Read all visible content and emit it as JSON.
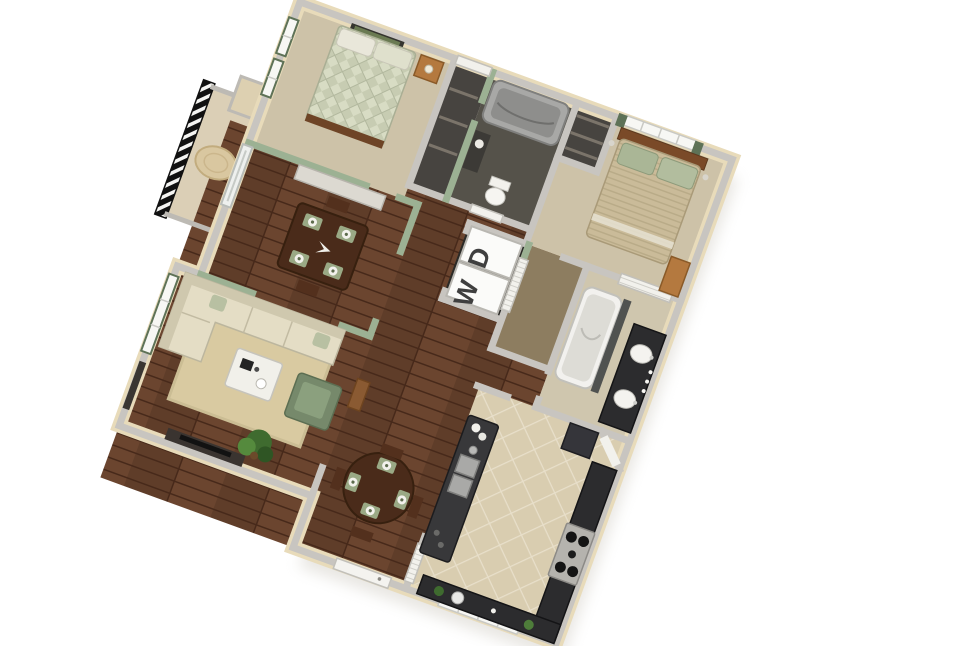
{
  "title": "3D apartment floor plan render",
  "appliance_labels": {
    "washer": "W",
    "dryer": "D"
  },
  "palette": {
    "wall_top": "#c8c5c0",
    "wall_exterior": "#e8dbba",
    "wall_green": "#9cb193",
    "trim_green": "#5e7257",
    "wood_base": "#5f3d29",
    "carpet": "#cdc2a8",
    "carpet_bath": "#cfc6ae",
    "carpet_dark": "#8d7d60",
    "tile": "#d9cdb0",
    "counter": "#2c2c2e",
    "steel": "#a9a9a7",
    "sofa": "#e4ddc5",
    "chair_green": "#76896b",
    "chair_green_light": "#8ba07e",
    "bed_plaid": "#c7ccb2",
    "bed_khaki": "#cabb99",
    "rug": "#d9caa1",
    "wood_furniture": "#4a2b1a",
    "wood_accent": "#7a4a28",
    "dresser": "#b4793f",
    "plant": "#4e7d3a",
    "dark_room": "#55524a",
    "closet_dark": "#474440",
    "laundry_dark": "#2b2a27",
    "tub_gray": "#a8a8a6",
    "white_fixture": "#f2f1ec",
    "letter": "#3f3f3f",
    "shadow": "#cdc9c0"
  },
  "rooms": [
    {
      "id": "bedroom-2",
      "floor": "carpet"
    },
    {
      "id": "hall-bathroom",
      "floor": "dark"
    },
    {
      "id": "hall-closet",
      "floor": "dark"
    },
    {
      "id": "master-bedroom",
      "floor": "carpet"
    },
    {
      "id": "laundry-closet",
      "appliances": [
        "washer",
        "dryer"
      ]
    },
    {
      "id": "walk-in-closet",
      "floor": "carpet-dark"
    },
    {
      "id": "master-bathroom",
      "floor": "carpet"
    },
    {
      "id": "dining-room",
      "floor": "hardwood"
    },
    {
      "id": "living-room",
      "floor": "hardwood"
    },
    {
      "id": "entry-dining-nook",
      "floor": "hardwood"
    },
    {
      "id": "kitchen",
      "floor": "tile"
    },
    {
      "id": "balcony",
      "floor": "concrete"
    }
  ]
}
